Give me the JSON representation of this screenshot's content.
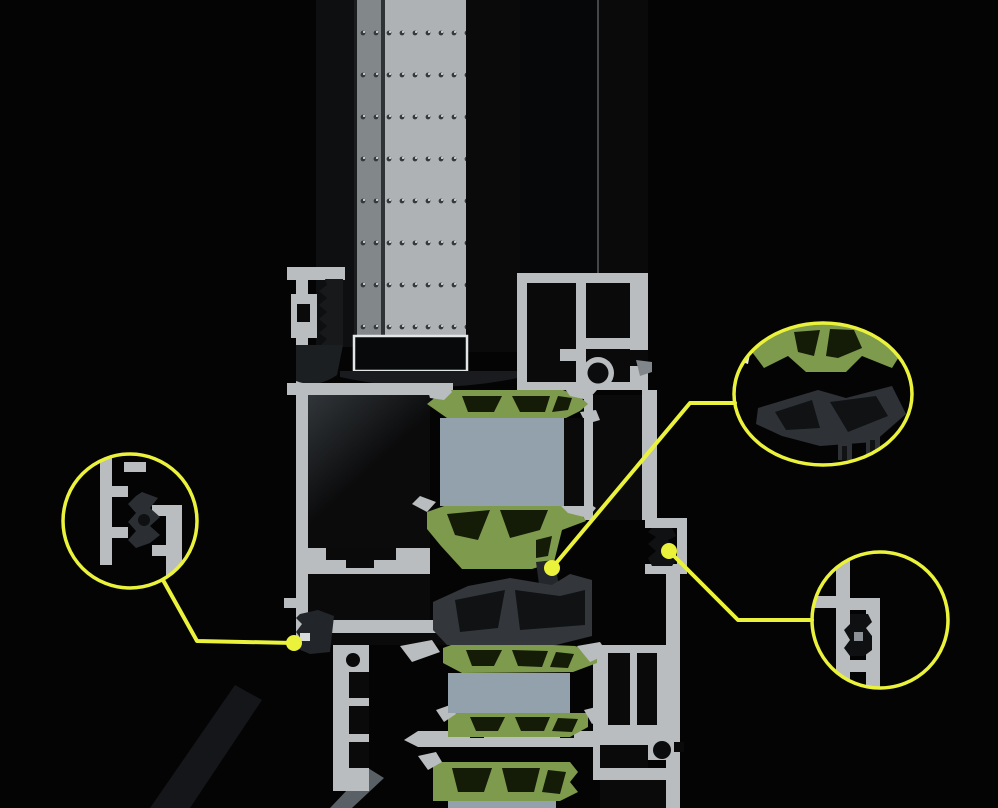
{
  "scene": {
    "type": "3d-render-cross-section",
    "subject": "thermally-broken-aluminium-window-profile",
    "background": "#040404"
  },
  "palette": {
    "aluminium": "#b9bdbf",
    "thermal_break_green": "#7e9a4c",
    "insulation_foam": "#93a1ad",
    "gasket_grey": "#33373b",
    "glass_dark": "#0d0f11",
    "spacer_grey": "#aeb2b4",
    "callout_yellow": "#ebf23c"
  },
  "glazing": {
    "spacer_dot_rows": 8,
    "spacer_dot_columns": 9
  },
  "callouts": [
    {
      "id": "left-gasket-detail",
      "shape": "circle",
      "cx": "130",
      "cy": "521",
      "r": "67",
      "leader": "163,580 197,641 294,643",
      "dot_x": "294",
      "dot_y": "643"
    },
    {
      "id": "thermal-break-detail",
      "shape": "ellipse",
      "cx": "823",
      "cy": "394",
      "rx": "89",
      "ry": "71",
      "leader": "735,403 690,403 552,568",
      "dot_x": "552",
      "dot_y": "568"
    },
    {
      "id": "right-gasket-detail",
      "shape": "circle",
      "cx": "880",
      "cy": "620",
      "r": "68",
      "leader": "812,620 738,620 669,551",
      "dot_x": "669",
      "dot_y": "551"
    }
  ]
}
